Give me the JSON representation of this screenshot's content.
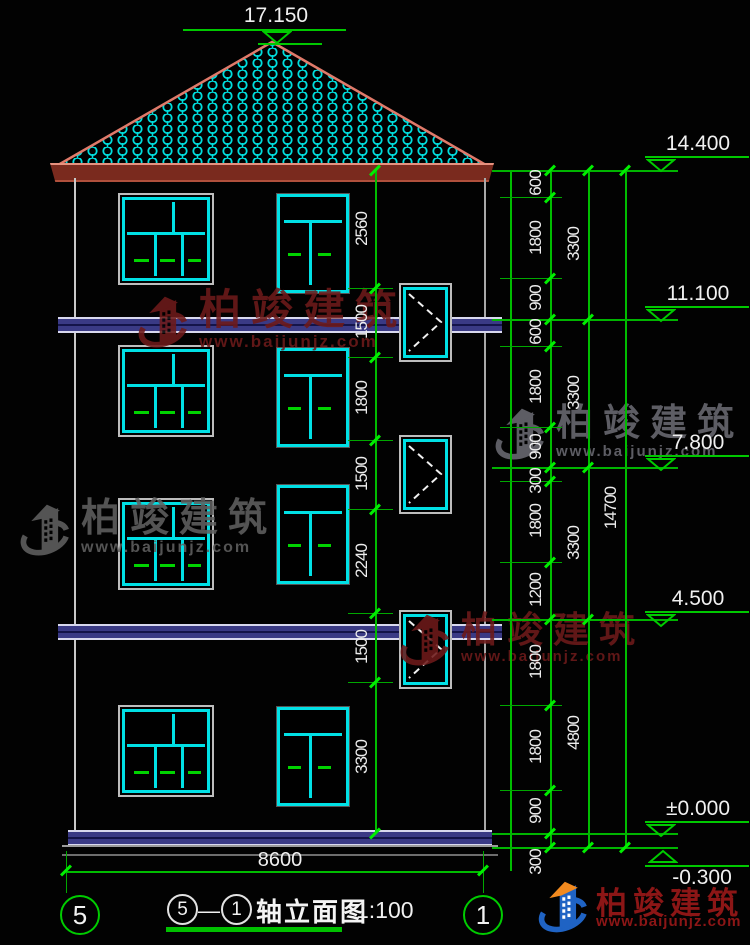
{
  "drawing": {
    "type": "building-elevation",
    "colors": {
      "background": "#000000",
      "cad_green": "#00c000",
      "cad_cyan": "#00e0e5",
      "roof_edge_red": "#e08070",
      "slab_blue": "#3a3a85",
      "watermark_red": "#6e1a1a",
      "watermark_gray": "#6a6a72",
      "logo_blue": "#1f63c4",
      "logo_orange": "#f28a1f"
    }
  },
  "elevation_markers": {
    "roof_top": "17.150",
    "eave": "14.400",
    "floor3": "11.100",
    "floor2": "7.800",
    "floor1": "4.500",
    "ground": "±0.000",
    "grade": "-0.300"
  },
  "dimensions": {
    "facade_chain": [
      "2560",
      "1500",
      "1800",
      "1500",
      "2240",
      "1500",
      "3300"
    ],
    "right_chain_segments": [
      "600",
      "1800",
      "900",
      "600",
      "1800",
      "900",
      "300",
      "1800",
      "1200",
      "1800",
      "1800",
      "900",
      "300"
    ],
    "right_chain_floors": [
      "3300",
      "3300",
      "3300",
      "4800"
    ],
    "right_chain_total": "14700",
    "width_total": "8600"
  },
  "axis_bubbles": {
    "left": "5",
    "right": "1"
  },
  "title": {
    "bubble_left": "5",
    "separator": "—",
    "bubble_right": "1",
    "label": "轴立面图",
    "scale": "1:100"
  },
  "watermark": {
    "brand": "柏竣建筑",
    "url": "www.baijunjz.com"
  },
  "logo": {
    "brand": "柏竣建筑",
    "url": "www.baijunjz.com"
  }
}
